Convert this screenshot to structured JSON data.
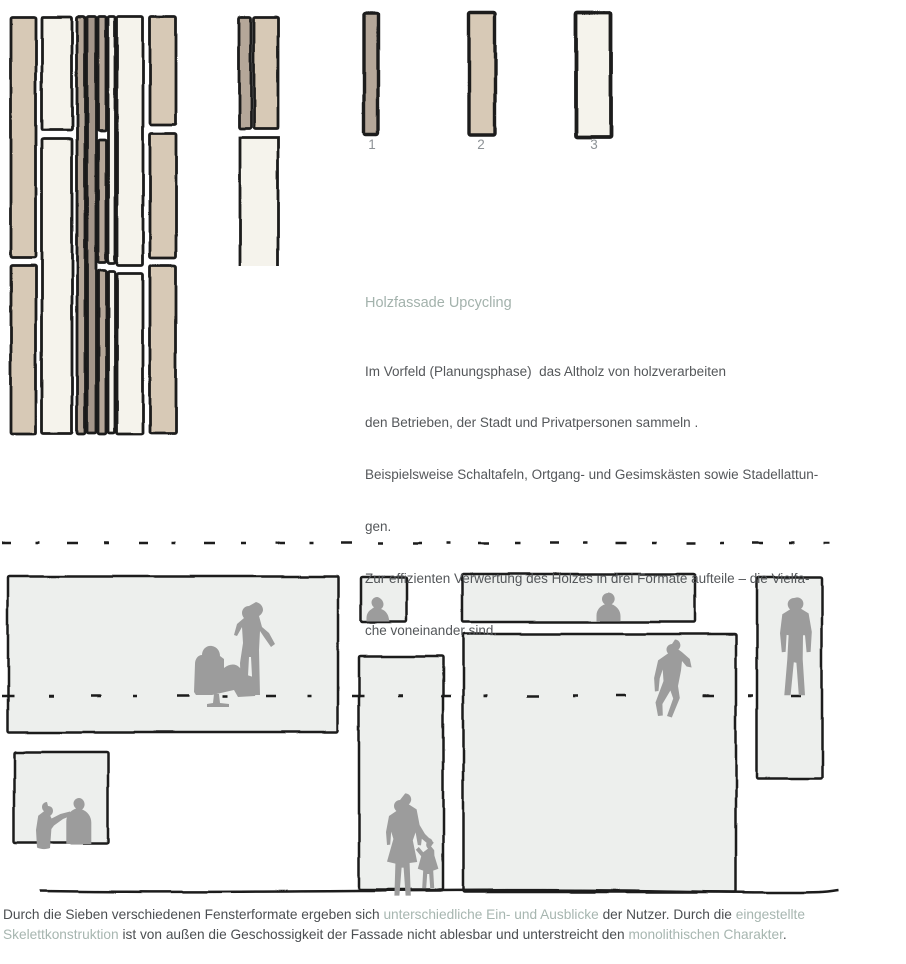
{
  "palette": {
    "ink": "#1a1a1a",
    "beige": "#d7c9b6",
    "taupe": "#b5a799",
    "taupe_dark": "#a4968a",
    "offwhite": "#f5f3ec",
    "window_fill": "#edefed",
    "silhouette": "#9c9c9c",
    "accent_text": "#a7b6b0",
    "body_text": "#54575a",
    "caption_text": "#4c4f52",
    "number_gray": "#8d9296"
  },
  "plank_formats": {
    "labels": [
      "1",
      "2",
      "3"
    ]
  },
  "section": {
    "heading": "Holzfassade Upcycling",
    "lines": [
      "Im Vorfeld (Planungsphase)  das Altholz von holzverarbeiten",
      "den Betrieben, der Stadt und Privatpersonen sammeln .",
      "Beispielsweise Schaltafeln, Ortgang- und Gesimskästen sowie Stadellattun-",
      "gen.",
      "Zur effizienten Verwertung des Holzes in drei Formate aufteile – die Vielfa-",
      "che voneinander sind."
    ]
  },
  "caption": {
    "lines": [
      [
        {
          "t": "Durch die Sieben verschiedenen Fensterformate ergeben sich ",
          "a": false
        },
        {
          "t": "unterschiedliche Ein- und Ausblicke",
          "a": true
        },
        {
          "t": " der Nutzer. Durch die ",
          "a": false
        },
        {
          "t": "eingestellte",
          "a": true
        }
      ],
      [
        {
          "t": "Skelettkonstruktion",
          "a": true
        },
        {
          "t": " ist von außen die Geschossigkeit der Fassade nicht ablesbar und unterstreicht den ",
          "a": false
        },
        {
          "t": "monolithischen Charakter",
          "a": true
        },
        {
          "t": ".",
          "a": false
        }
      ]
    ]
  },
  "figures": {
    "facade": {
      "columns": [
        {
          "x": 11,
          "w": 25,
          "color": "beige",
          "segs": [
            [
              17,
              257
            ],
            [
              265,
              434
            ]
          ]
        },
        {
          "x": 42,
          "w": 30,
          "color": "offwhite",
          "segs": [
            [
              17,
              130
            ],
            [
              139,
              433
            ]
          ]
        },
        {
          "x": 77,
          "w": 8,
          "color": "taupe",
          "segs": [
            [
              17,
              434
            ]
          ]
        },
        {
          "x": 87,
          "w": 9,
          "color": "taupe_dark",
          "segs": [
            [
              17,
              433
            ]
          ]
        },
        {
          "x": 98,
          "w": 8,
          "color": "taupe",
          "segs": [
            [
              17,
              130
            ],
            [
              139,
              263
            ],
            [
              271,
              434
            ]
          ]
        },
        {
          "x": 108,
          "w": 7,
          "color": "offwhite",
          "segs": [
            [
              17,
              264
            ],
            [
              272,
              433
            ]
          ]
        },
        {
          "x": 117,
          "w": 26,
          "color": "offwhite",
          "segs": [
            [
              17,
              266
            ],
            [
              274,
              434
            ]
          ]
        },
        {
          "x": 150,
          "w": 26,
          "color": "beige",
          "segs": [
            [
              17,
              124
            ],
            [
              133,
              258
            ],
            [
              266,
              433
            ]
          ]
        },
        {
          "x": 239,
          "w": 12,
          "color": "taupe",
          "segs": [
            [
              17,
              129
            ]
          ]
        },
        {
          "x": 254,
          "w": 24,
          "color": "beige",
          "segs": [
            [
              17,
              129
            ]
          ]
        }
      ],
      "open_plank": {
        "x": 240,
        "w": 38,
        "color": "offwhite",
        "y1": 138,
        "y2": 266
      }
    },
    "samples": [
      {
        "x": 364,
        "y": 14,
        "w": 14,
        "h": 120,
        "color": "taupe",
        "sw": 3.4
      },
      {
        "x": 469,
        "y": 13,
        "w": 26,
        "h": 122,
        "color": "beige",
        "sw": 3.4
      },
      {
        "x": 576,
        "y": 13,
        "w": 35,
        "h": 124,
        "color": "offwhite",
        "sw": 3.8
      }
    ],
    "elevation": {
      "windows": [
        {
          "name": "window-large-left",
          "x": 8,
          "y": 576,
          "w": 330,
          "h": 156
        },
        {
          "name": "window-small-square-top",
          "x": 361,
          "y": 577,
          "w": 46,
          "h": 45
        },
        {
          "name": "window-wide-band",
          "x": 462,
          "y": 574,
          "w": 233,
          "h": 48
        },
        {
          "name": "window-tall-narrow-right",
          "x": 757,
          "y": 577,
          "w": 65,
          "h": 201
        },
        {
          "name": "window-large-center",
          "x": 463,
          "y": 634,
          "w": 273,
          "h": 258
        },
        {
          "name": "window-tall-middle",
          "x": 359,
          "y": 656,
          "w": 84,
          "h": 234
        },
        {
          "name": "window-square-bottom-left",
          "x": 14,
          "y": 752,
          "w": 94,
          "h": 91
        }
      ],
      "dash_lines": [
        {
          "y": 543,
          "x1": 2,
          "x2": 830,
          "dash": "9 24 4 28 11 26 5 30",
          "w": 2.6
        },
        {
          "y": 696,
          "x1": 2,
          "x2": 833,
          "dash": "12 34 5 38 10 32 4 40",
          "w": 2.4
        }
      ],
      "ground": {
        "d": "M40 891 C240 894 480 888 660 891 S820 892 838 890"
      },
      "silhouettes": [
        {
          "name": "seated-person-chair-silhouette",
          "d": "M194 692l1-28c0-5 3-9 7-9 0-6 5-10 10-9 5 1 8 5 8 10l4 3 0 9c5-4 11-5 15-1l8 8 9 3 2 9-3 9-17 1-4-7-22 5-16 0z"
        },
        {
          "name": "chair-pedestal-silhouette",
          "d": "M214 694l5 0 1 9 9 1 0 3-22 0 0-3 6-1z"
        },
        {
          "name": "standing-person-phone-silhouette",
          "d": "M249 606c-4 0-7 3-7 7 0 2 1 4 2 5l-7 6-3 11 3 1 5-9 1 16-3 20 1 32 6 0 2-38 2 0 2 38 7 0-1-45 1-19 4 6 7 10 4-3-6-11-7-6-3-11c2-1 4-4 4-6 0-4-3-7-7-8z"
        },
        {
          "name": "bust-small-window-silhouette",
          "d": "M377 597c-3 0-5.5 2.5-5.5 5.5 0 2 1 3.7 2.5 4.7l-3 2.3c-3 2-4.5 5-4.5 8.5l0 3.5 23 0-1-4.5c-1-4-4-7-7.5-8 1.5-1 2.5-2.8 2.5-4.8 0-3-2.5-6.2-6-7.2z"
        },
        {
          "name": "bust-band-window-silhouette",
          "d": "M608 593c-3.3 0-6 2.7-6 6 0 2.2 1.2 4.2 3 5.3-5 1.7-8.5 6-8.5 11.2l0 6 24 0 0-5.5c0-5.5-3.7-10-8.8-11.8 1.8-1.1 3-3.1 3-5.4 0-3.6-3-6.3-6.7-6.3z"
        },
        {
          "name": "walking-man-silhouette",
          "d": "M794 598c-3.5 0-6.3 2.8-6.3 6.3 0 2 1 3.9 2.4 5.1l-7.8 4.8-2.3 19 1.8 19 3.8-.3 1-17 2 .3-1.3 24-3 36 6.3 0 3.2-33 2.6.6 2.4 32.4 6.2 0-2.3-36 .3-24 2 0 1.6 17 4-.3 1.2-20-3.2-18.5-7.6-4.6c1.5-1.2 2.4-3 2.4-5.1 0-3.5-2.8-6.3-6.4-6.3z"
        },
        {
          "name": "climbing-man-silhouette",
          "d": "M672 644c-3 0-5.5 2.5-5.5 5.5 0 1.5.6 2.9 1.6 3.9l-10 7-4 17.6.8 13.5 3.6-.5 1.2-12.5 3-9 .8 11.5-8 21.5 2.5 13.5 4.8-.5-.4-11.5 8-13.5 2.8 8-6.2 17.5 4.8 1.5 8-19.5-1.8-12 3-15.5 1-9.5 4.6 5.5 5 1-1.8-8.5-8-7-3.4-2.5c1.2-1 2-2.5 2-4.2 0-3-2.4-5.8-5.4-5.8z"
        },
        {
          "name": "woman-silhouette",
          "d": "M400 800c-3.3 0-6 2.7-6 6 0 2 1 3.8 2.4 5l-7.4 5-3 16 1 13 3.2-.4 1-13 2.2 7.4-6.4 22.6 8.4 2-1 32 5 0 2.2-28 2 0 2 28 5.2 0-1.2-32.6 7.6-1-4.4-21.6 2.8-8 2.2 12.6 3.2.4.8-6.6 9 7.6 3-3.6-8.8-8.8-5.4-9-3-15.6-7.8-5c1.4-1.2 2.4-3 2.4-5 0-3.3-2.7-6-6-6z"
        },
        {
          "name": "child-silhouette",
          "d": "M431 840c-2.7 0-4.8 2.1-4.8 4.8 0 1.5.7 2.9 1.8 3.8l-4.8 3.6-4.4-5.2-3 2.8 5.4 6.4-3.4 12.6 5.4 1.8-1 17.4 4 0 1-14 2 0 1 14 4 0-1-17.4 5.2-1.8-4-13.2-.2-5.4-3.2-4c1-.9 1.7-2.2 1.7-3.6 0-2.7-2.1-4.6-4.7-4.6z"
        },
        {
          "name": "person-gesturing-silhouette",
          "d": "M47 802c-2.8 0-5 2.2-5 5 0 1.7.8 3.2 2 4.2l-5.8 4.6-2.2 14.2 1 17.5c4 2 9 2 13 .5l1.4-19 2.6-3.5 9-6.5 8.6-3.5-1.6-4-9.6 2.5-8.8 4.5-1.4-2.8c1.6-1 2.8-2.8 2.8-5 0-2.8-2.2-4.7-5-4.7z"
        },
        {
          "name": "person-listening-silhouette",
          "d": "M79 798c-3 0-5.5 2.5-5.5 5.5 0 2 1 3.9 2.6 5-5.8 2-9.8 7-9.8 13l0 22.5 25 0 0-21.5c0-6-3.8-11-9.2-13 1.5-1.1 2.5-3 2.5-5.2 0-3.3-2.6-6.3-5.6-6.3z"
        }
      ]
    }
  }
}
